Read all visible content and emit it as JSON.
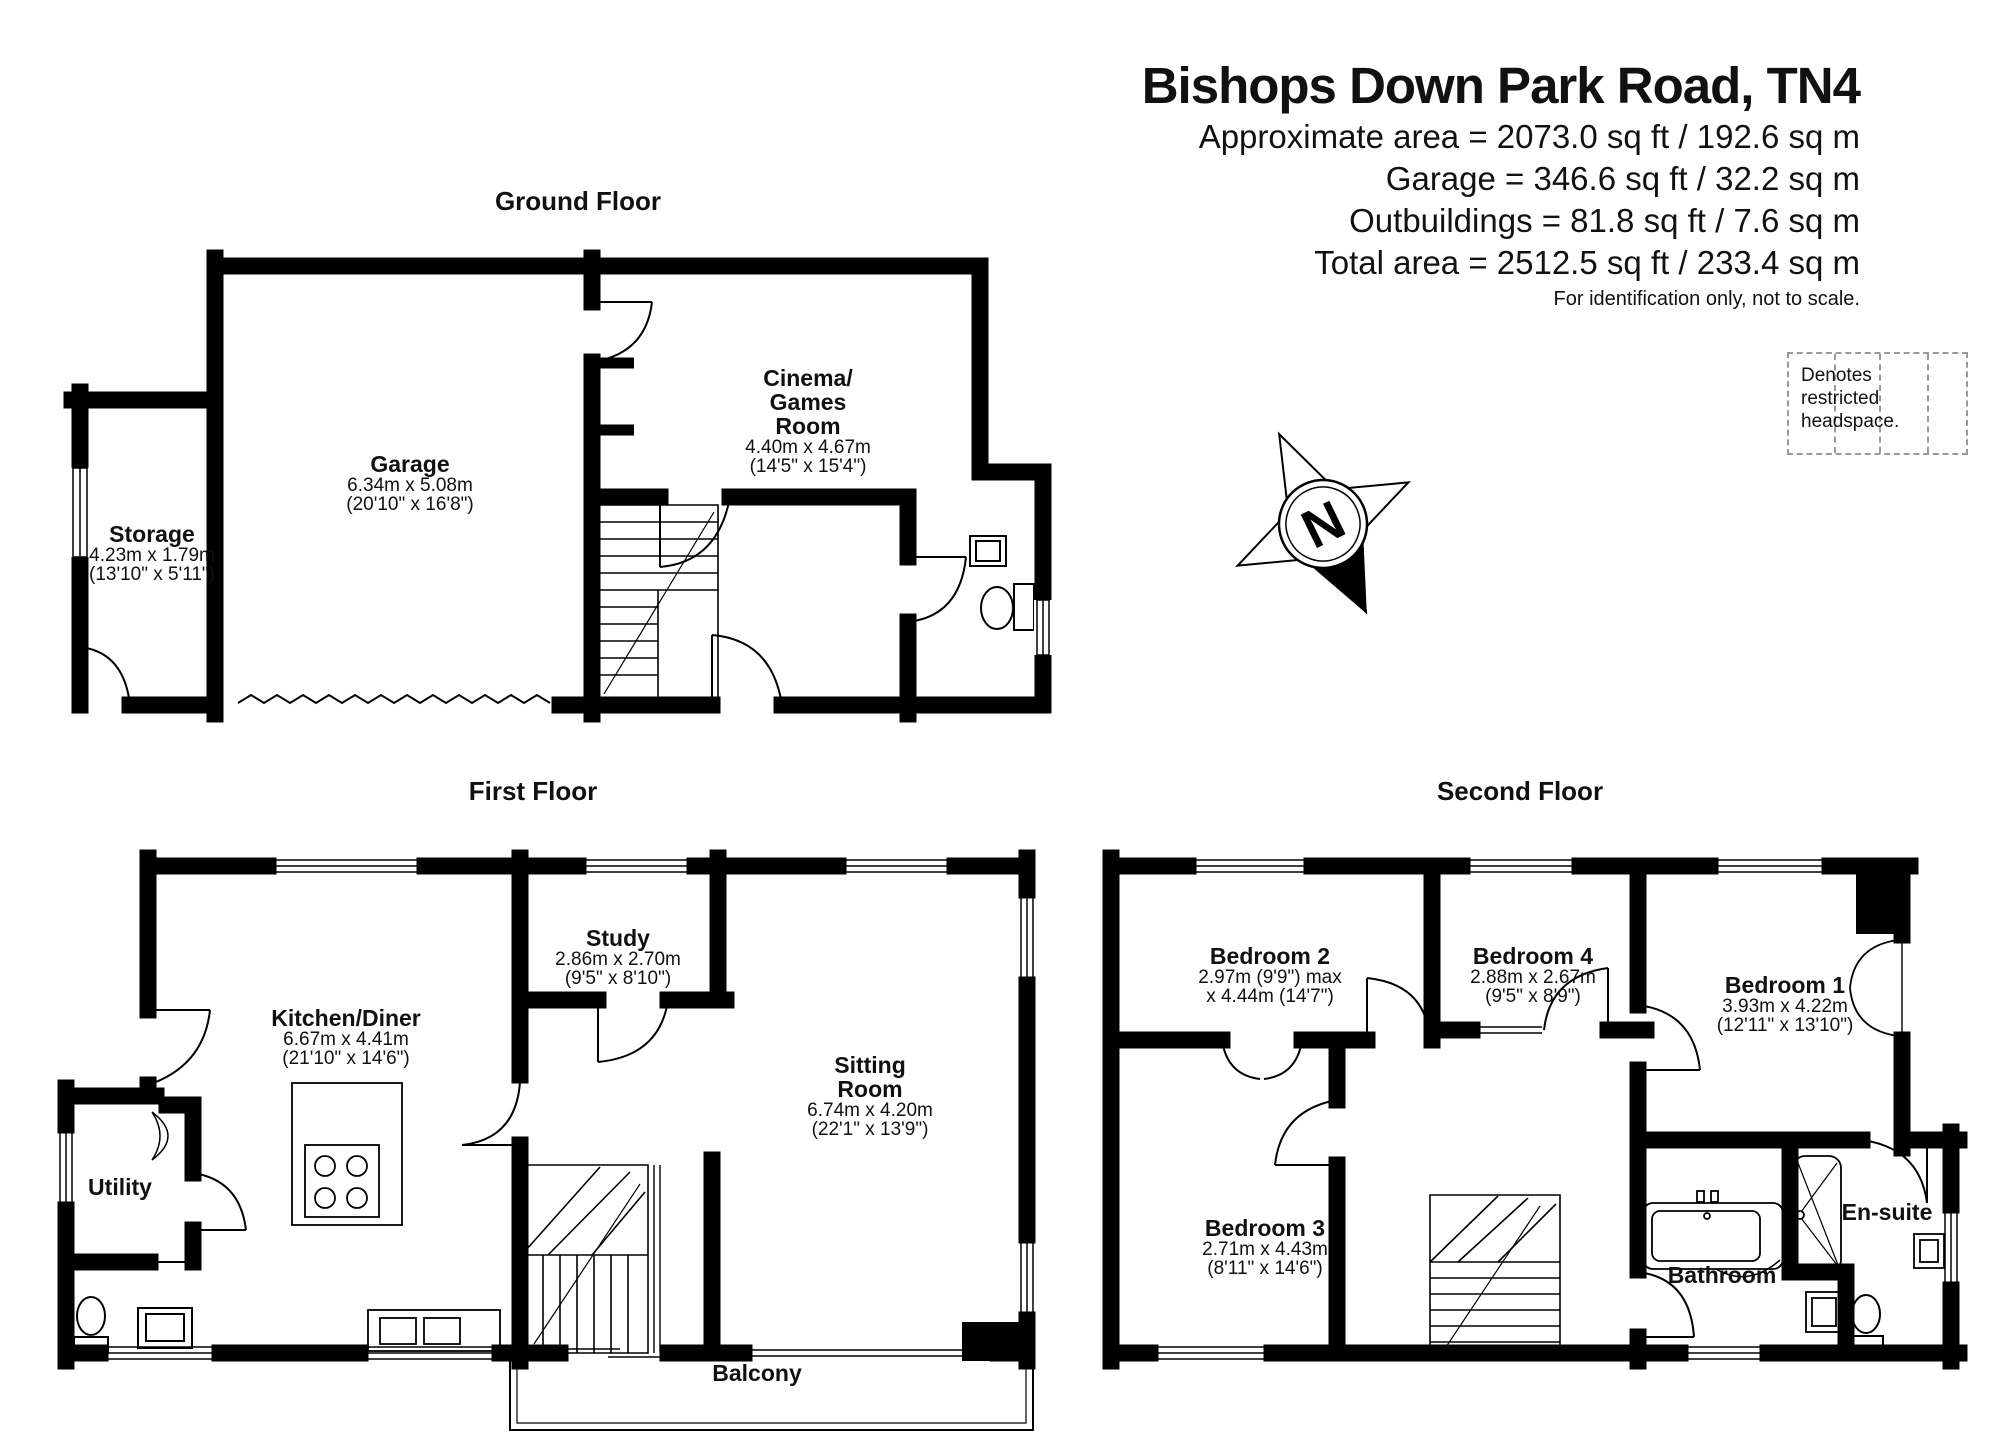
{
  "header": {
    "title": "Bishops Down Park Road, TN4",
    "area_lines": [
      "Approximate area = 2073.0 sq ft / 192.6 sq m",
      "Garage = 346.6 sq ft / 32.2 sq m",
      "Outbuildings = 81.8 sq ft / 7.6 sq m",
      "Total area = 2512.5 sq ft / 233.4 sq m"
    ],
    "disclaimer": "For identification only, not to scale.",
    "legend_label": "Denotes restricted headspace."
  },
  "compass": {
    "north_label": "N"
  },
  "floors": {
    "ground": {
      "title": "Ground Floor",
      "rooms": {
        "garage": {
          "name": "Garage",
          "dims_metric": "6.34m x 5.08m",
          "dims_imperial": "(20'10\" x 16'8\")"
        },
        "storage": {
          "name": "Storage",
          "dims_metric": "4.23m x 1.79m",
          "dims_imperial": "(13'10\" x 5'11\")"
        },
        "cinema": {
          "name_line1": "Cinema/",
          "name_line2": "Games",
          "name_line3": "Room",
          "dims_metric": "4.40m x 4.67m",
          "dims_imperial": "(14'5\" x 15'4\")"
        }
      }
    },
    "first": {
      "title": "First Floor",
      "rooms": {
        "kitchen": {
          "name": "Kitchen/Diner",
          "dims_metric": "6.67m x 4.41m",
          "dims_imperial": "(21'10\" x 14'6\")"
        },
        "study": {
          "name": "Study",
          "dims_metric": "2.86m x 2.70m",
          "dims_imperial": "(9'5\" x 8'10\")"
        },
        "sitting": {
          "name_line1": "Sitting",
          "name_line2": "Room",
          "dims_metric": "6.74m x 4.20m",
          "dims_imperial": "(22'1\" x 13'9\")"
        },
        "utility": {
          "name": "Utility"
        },
        "balcony": {
          "name": "Balcony"
        }
      }
    },
    "second": {
      "title": "Second Floor",
      "rooms": {
        "bedroom2": {
          "name": "Bedroom 2",
          "dims_metric": "2.97m (9'9\") max",
          "dims_imperial": "x 4.44m (14'7\")"
        },
        "bedroom4": {
          "name": "Bedroom 4",
          "dims_metric": "2.88m x 2.67m",
          "dims_imperial": "(9'5\" x 8'9\")"
        },
        "bedroom1": {
          "name": "Bedroom 1",
          "dims_metric": "3.93m x 4.22m",
          "dims_imperial": "(12'11\" x 13'10\")"
        },
        "bedroom3": {
          "name": "Bedroom 3",
          "dims_metric": "2.71m x 4.43m",
          "dims_imperial": "(8'11\" x 14'6\")"
        },
        "bathroom": {
          "name": "Bathroom"
        },
        "ensuite": {
          "name": "En-suite"
        }
      }
    }
  },
  "colors": {
    "wall": "#000000",
    "text": "#111111",
    "legend_line": "#9a9a9a"
  }
}
